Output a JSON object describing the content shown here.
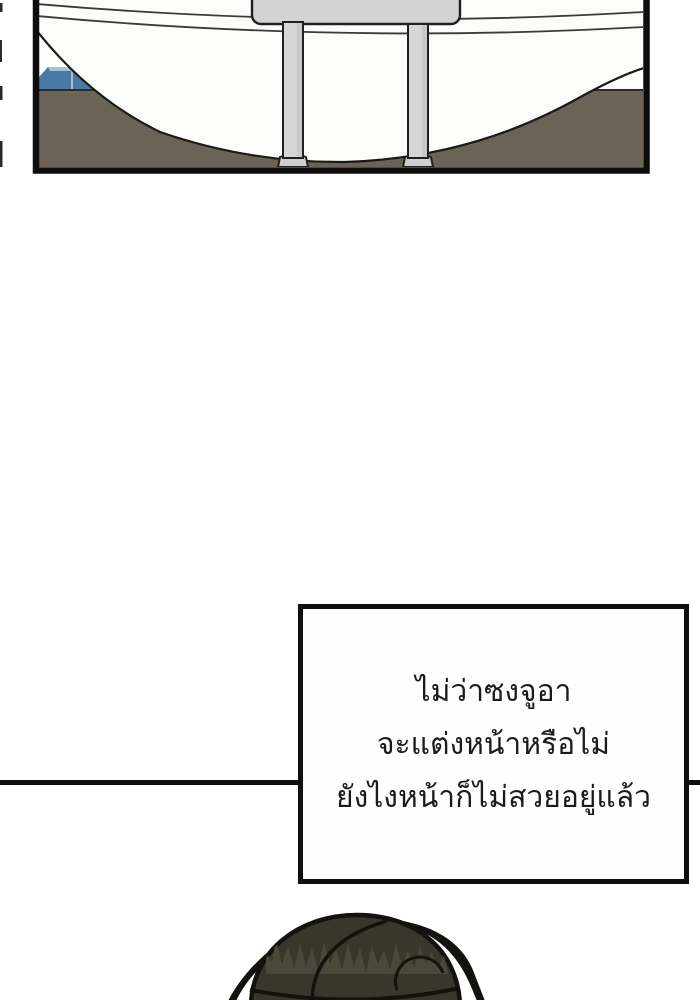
{
  "speech_box": {
    "lines": [
      "ไม่ว่าซงจูอา",
      "จะแต่งหน้าหรือไม่",
      "ยังไงหน้าก็ไม่สวยอยู่แล้ว"
    ]
  },
  "colors": {
    "page_background": "#ffffff",
    "panel_border": "#0d0d0d",
    "divider_line": "#0d0d0d",
    "tub_white": "#fcfcfa",
    "floor_brown": "#6b6356",
    "floor_edge": "#2e2c28",
    "accent_blue": "#4a7aa4",
    "accent_blue_light": "#a9bfd2",
    "fixture_gray": "#d3d3d3",
    "fixture_gray_shade": "#bdbdbd",
    "fixture_outline": "#202020",
    "hair_base": "#39362b",
    "hair_highlight": "#4c4839",
    "hair_outline": "#14120e",
    "speech_text": "#1b1b1b"
  }
}
